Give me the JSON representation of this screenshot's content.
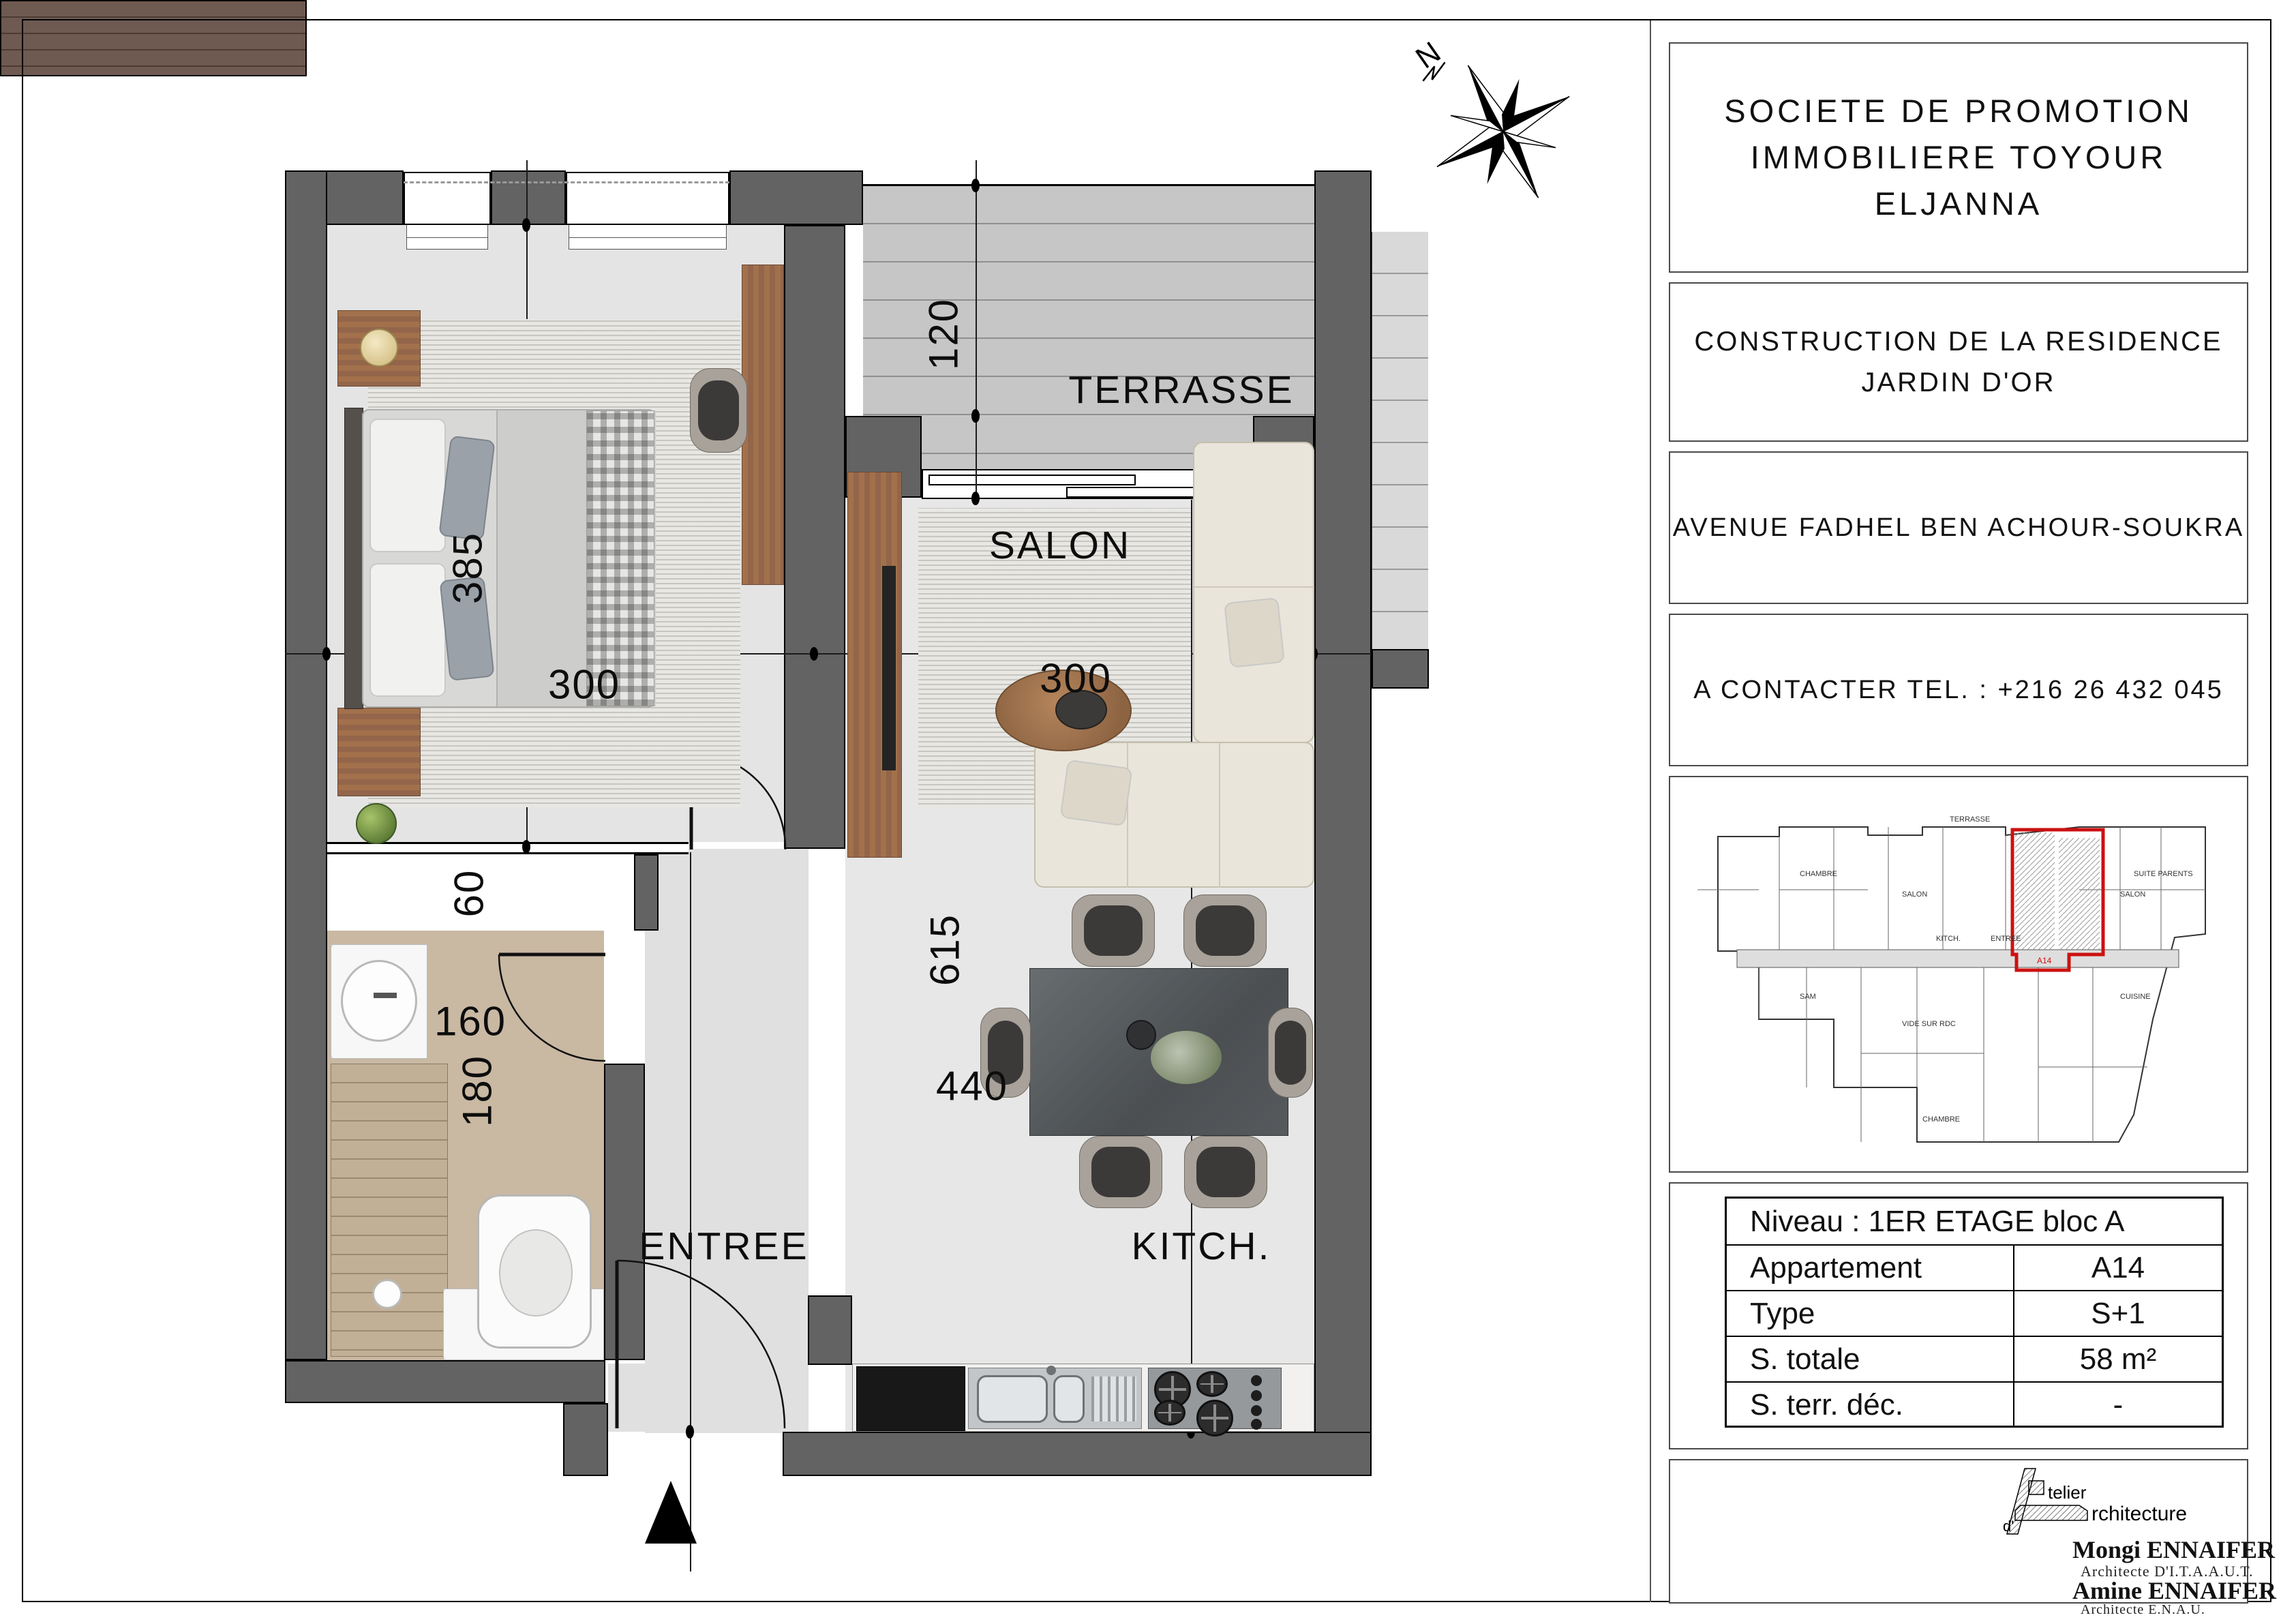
{
  "title_block": {
    "company_line1": "SOCIETE  DE  PROMOTION",
    "company_line2": "IMMOBILIERE  TOYOUR  ELJANNA",
    "project_line1": "CONSTRUCTION  DE LA RESIDENCE",
    "project_line2": "JARDIN D'OR",
    "address": "AVENUE FADHEL BEN ACHOUR-SOUKRA",
    "contact": "A  CONTACTER  TEL. :  +216 26 432 045",
    "table": {
      "niveau": "Niveau : 1ER ETAGE bloc A",
      "rows": [
        [
          "Appartement",
          "A14"
        ],
        [
          "Type",
          "S+1"
        ],
        [
          "S. totale",
          "58 m²"
        ],
        [
          "S. terr. déc.",
          "-"
        ]
      ]
    },
    "architect": {
      "logo_telier": "telier",
      "logo_d": "d'",
      "logo_rchitecture": "rchitecture",
      "name1": "Mongi ENNAIFER",
      "title1": "Architecte D'I.T.A.A.U.T.",
      "name2": "Amine ENNAIFER",
      "title2": "Architecte  E.N.A.U."
    }
  },
  "plan": {
    "north": "N",
    "rooms": {
      "terrasse": "TERRASSE",
      "salon": "SALON",
      "entree": "ENTREE",
      "kitchen": "KITCH."
    },
    "dims": {
      "terrasse_depth": "120",
      "bedroom_depth": "385",
      "bedroom_width": "300",
      "salon_width": "300",
      "closet_depth": "60",
      "bath_width": "160",
      "bath_depth": "180",
      "living_depth": "615",
      "living_width": "440"
    }
  },
  "key_plan": {
    "labels": [
      "CHAMBRE",
      "SALON",
      "TERRASSE",
      "SALON",
      "KITCH.",
      "ENTREE",
      "SAM",
      "CUISINE",
      "SUITE PARENTS",
      "CHAMBRE",
      "A14",
      "VIDE SUR RDC"
    ]
  },
  "colors": {
    "wall": "#636363",
    "unit_highlight": "#cc1111",
    "bath_floor": "#c9b8a2",
    "closet": "#6f5a51",
    "wood": "#9c6c49"
  }
}
